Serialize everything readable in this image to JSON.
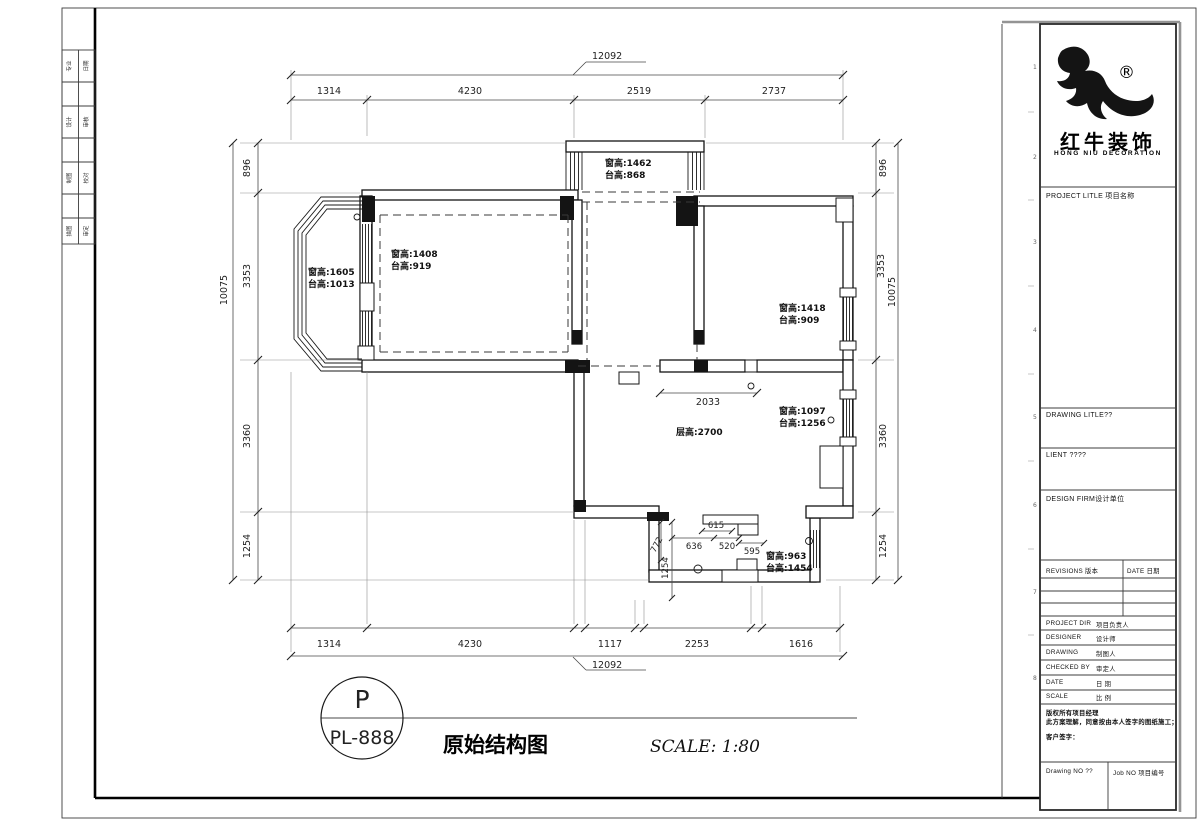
{
  "sheet": {
    "stamp_letter": "P",
    "stamp_number": "PL-888",
    "drawing_title": "原始结构图",
    "scale_note": "SCALE: 1:80"
  },
  "logo": {
    "reg": "®",
    "cn": "红牛装饰",
    "en": "HONG NIU DECORATION"
  },
  "titleblock": {
    "project_title": "PROJECT LITLE  项目名称",
    "drawing_title": "DRAWING LITLE??",
    "client": "LIENT ????",
    "design_firm": "DESIGN FIRM设计单位",
    "revisions": "REVISIONS 版本",
    "rev_date": "DATE 日期",
    "rows": [
      {
        "en": "PROJECT DIR",
        "cn": "项目负责人"
      },
      {
        "en": "DESIGNER",
        "cn": "设计师"
      },
      {
        "en": "DRAWING",
        "cn": "制图人"
      },
      {
        "en": "CHECKED BY",
        "cn": "审定人"
      },
      {
        "en": "DATE",
        "cn": "日 期"
      },
      {
        "en": "SCALE",
        "cn": "比 例"
      }
    ],
    "copyright_l1": "版权所有项目经理",
    "copyright_l2": "此方案理解，同意按由本人签字的图纸施工；",
    "customer_sign": "客户签字：",
    "drawing_no": "Drawing NO ??",
    "job_no": "Job NO 项目编号",
    "ruler_marks": [
      "1",
      "2",
      "3",
      "4",
      "5",
      "6",
      "7",
      "8"
    ]
  },
  "signbar": {
    "cells": [
      [
        "专业",
        "日期"
      ],
      [
        "设计",
        "审核"
      ],
      [
        "制图",
        "校对"
      ],
      [
        "描图",
        "审定"
      ]
    ]
  },
  "dims": {
    "top_total": "12092",
    "bottom_total": "12092",
    "left_total": "10075",
    "right_total": "10075",
    "top": [
      "1314",
      "4230",
      "2519",
      "2737"
    ],
    "bottom": [
      "1314",
      "4230",
      "1117",
      "2253",
      "1616"
    ],
    "left": [
      "896",
      "3353",
      "3360",
      "1254"
    ],
    "right": [
      "896",
      "3353",
      "3360",
      "1254"
    ],
    "interior": {
      "hall_width": "2033",
      "d615": "615",
      "d636": "636",
      "d520": "520",
      "d595": "595",
      "d772": "772",
      "d1254": "1254"
    }
  },
  "annotations": {
    "floor_height": "层高:2700",
    "windows": [
      {
        "l1": "窗高:1462",
        "l2": "台高:868"
      },
      {
        "l1": "窗高:1605",
        "l2": "台高:1013"
      },
      {
        "l1": "窗高:1408",
        "l2": "台高:919"
      },
      {
        "l1": "窗高:1418",
        "l2": "台高:909"
      },
      {
        "l1": "窗高:1097",
        "l2": "台高:1256"
      },
      {
        "l1": "窗高:963",
        "l2": "台高:1454"
      }
    ]
  }
}
